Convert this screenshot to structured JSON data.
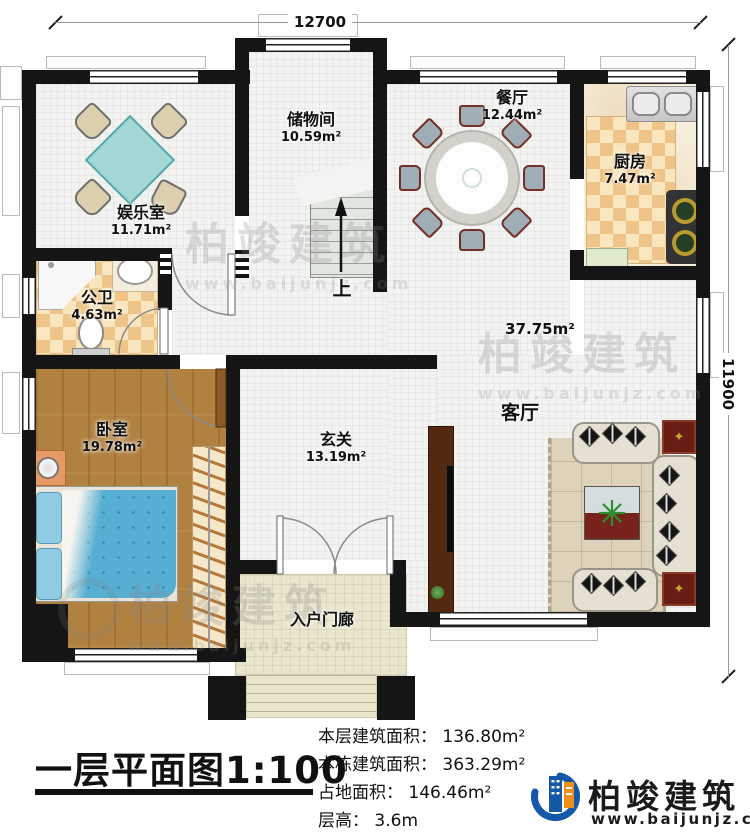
{
  "dimensions": {
    "top": "12700",
    "right": "11900"
  },
  "rooms": [
    {
      "id": "entertainment",
      "name": "娱乐室",
      "area": "11.71m²"
    },
    {
      "id": "storage",
      "name": "储物间",
      "area": "10.59m²"
    },
    {
      "id": "dining",
      "name": "餐厅",
      "area": "12.44m²"
    },
    {
      "id": "kitchen",
      "name": "厨房",
      "area": "7.47m²"
    },
    {
      "id": "bathroom",
      "name": "公卫",
      "area": "4.63m²"
    },
    {
      "id": "bedroom",
      "name": "卧室",
      "area": "19.78m²"
    },
    {
      "id": "foyer",
      "name": "玄关",
      "area": "13.19m²"
    },
    {
      "id": "living",
      "name": "客厅",
      "area": "37.75m²"
    },
    {
      "id": "porch",
      "name": "入户门廊",
      "area": ""
    }
  ],
  "stairs": {
    "up_label": "上"
  },
  "title": {
    "text": "一层平面图1:100"
  },
  "stats": [
    {
      "label": "本层建筑面积",
      "value": "136.80m²"
    },
    {
      "label": "本栋建筑面积",
      "value": "363.29m²"
    },
    {
      "label": "占地面积",
      "value": "146.46m²"
    },
    {
      "label": "层高",
      "value": "3.6m"
    }
  ],
  "ui": {
    "colon": "： "
  },
  "brand": {
    "name": "柏竣建筑",
    "site": "www.baijunjz.com"
  },
  "colors": {
    "wall": "#151515",
    "brand_blue": "#1558a8",
    "brand_orange": "#ef9018",
    "wood_floor": "#b18140",
    "checker_tile": "#eec488",
    "tile": "#f3f3f1",
    "table_teal": "#a5d6d8",
    "bed_blue": "#56aed2",
    "side_table_red": "#6a1d13"
  }
}
